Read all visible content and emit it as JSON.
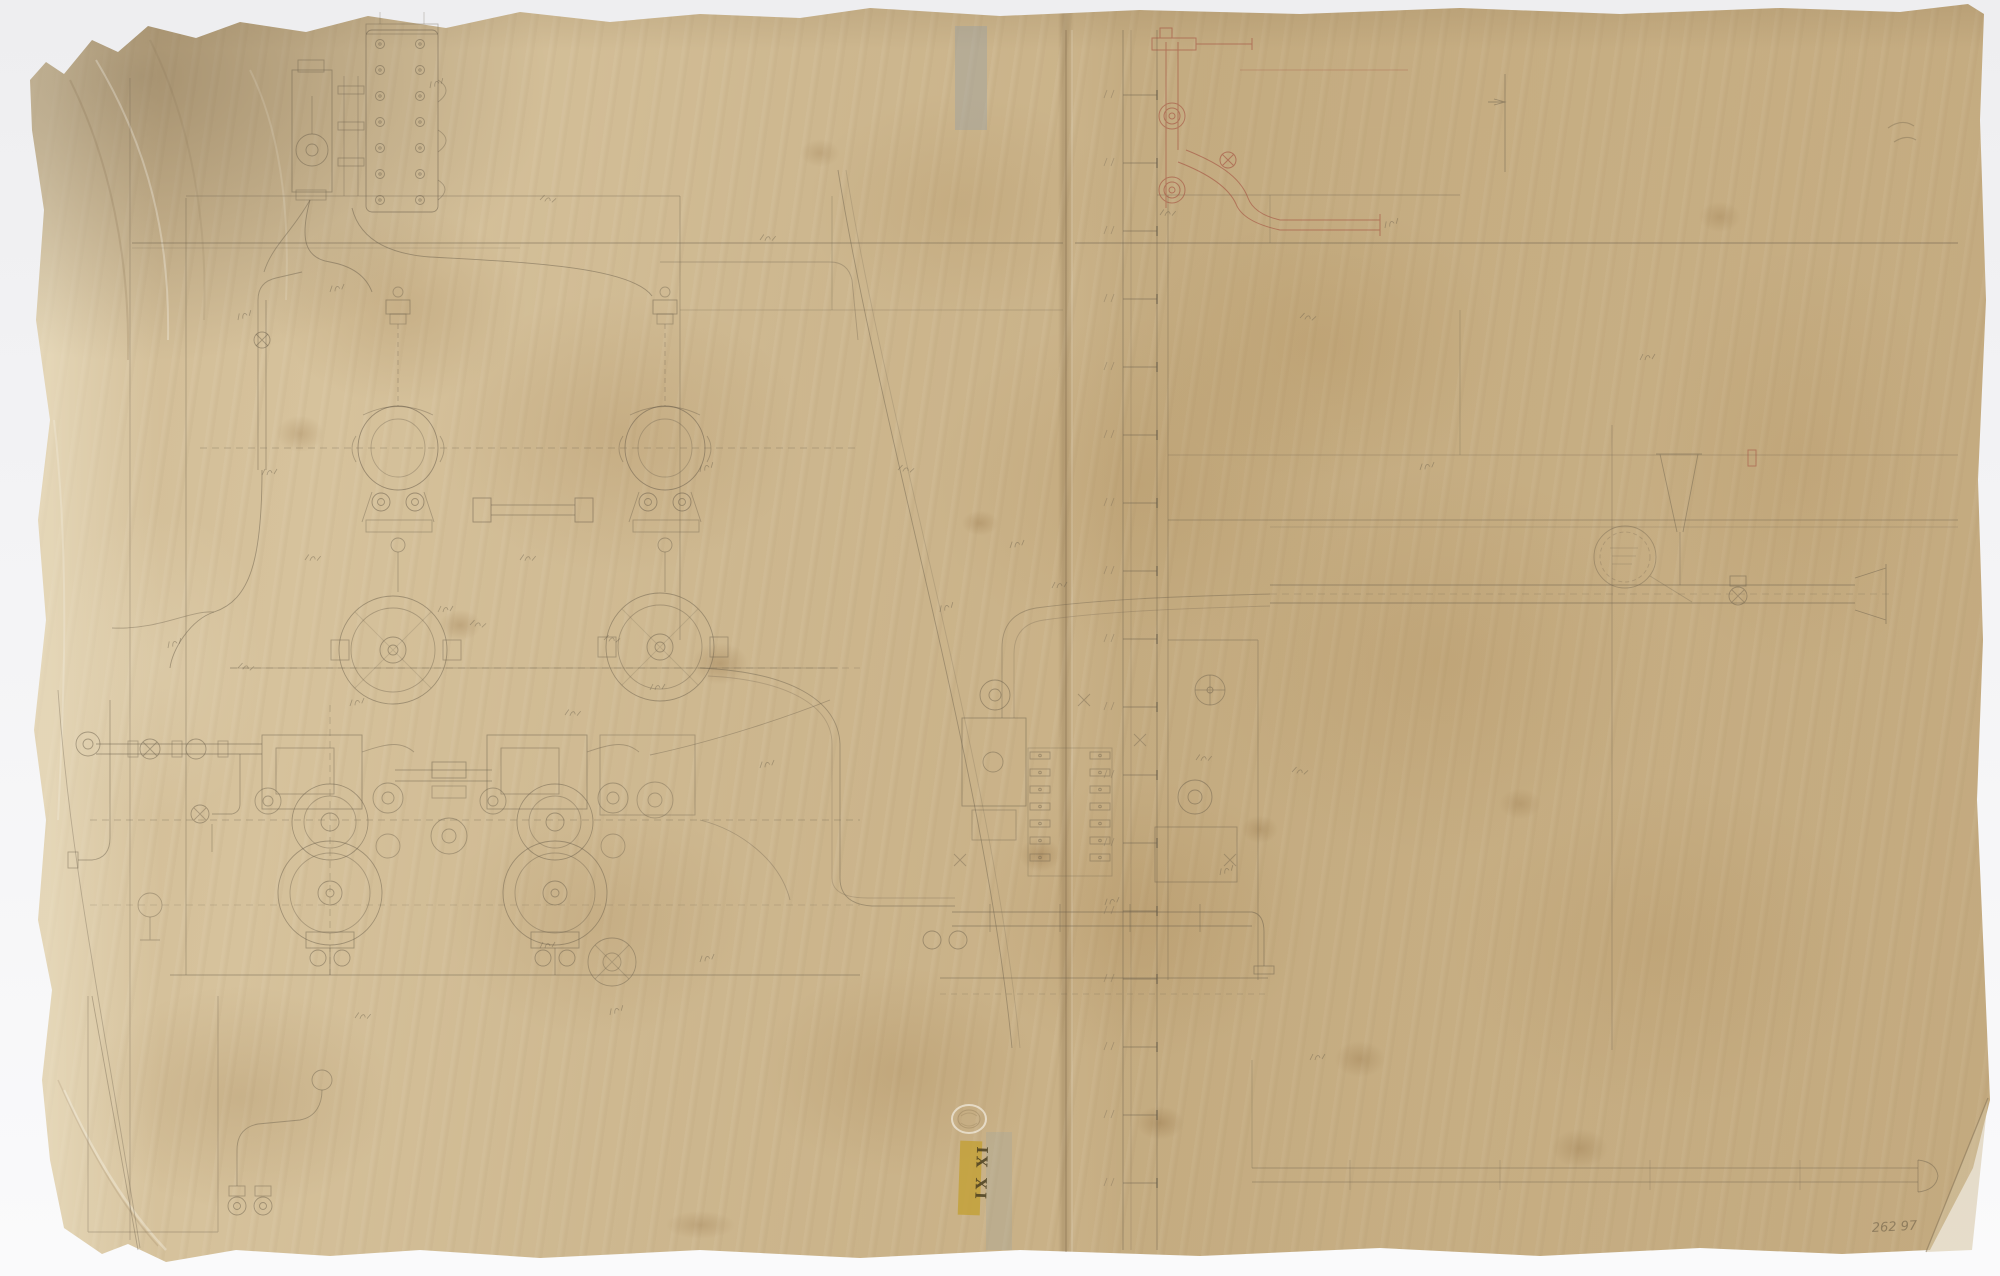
{
  "ink": {
    "graphite": "#6b5f4c",
    "graphite_soft": "#857760",
    "red": "#a34f3f"
  },
  "paper": {
    "base": "#cdb68e",
    "backdrop": "#ededef",
    "tape_grey": "#96a0a6"
  },
  "stamps": {
    "catalog_stamp": {
      "text": "IX XI",
      "bg": "#c3a035",
      "fg": "#4a3f20"
    },
    "pencil_note": {
      "text": "262 97",
      "color": "#6e6048"
    }
  }
}
